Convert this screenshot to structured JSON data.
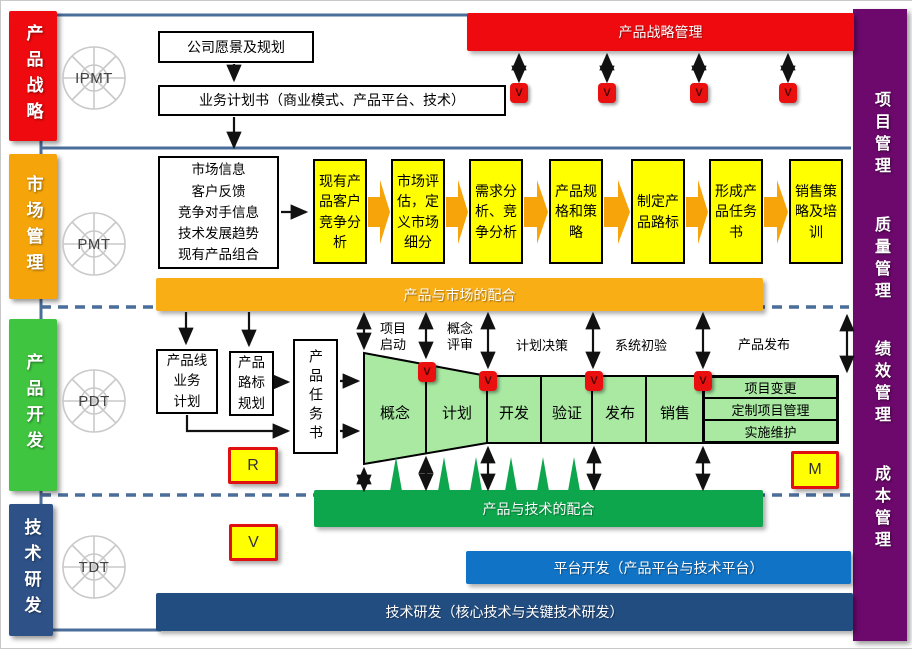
{
  "title": "IPD流程总体框架图",
  "left_bars": [
    {
      "label": "产品战略",
      "color": "#ee0a0e"
    },
    {
      "label": "市场管理",
      "color": "#f5a50a"
    },
    {
      "label": "产品开发",
      "color": "#3fc53f"
    },
    {
      "label": "技术研发",
      "color": "#2e5288"
    }
  ],
  "teams": [
    {
      "label": "IPMT"
    },
    {
      "label": "PMT"
    },
    {
      "label": "PDT"
    },
    {
      "label": "TDT"
    }
  ],
  "right_bar": {
    "items": [
      "项目管理",
      "质量管理",
      "绩效管理",
      "成本管理"
    ]
  },
  "strategy": {
    "banner": "产品战略管理",
    "vision_box": "公司愿景及规划",
    "business_plan_box": "业务计划书（商业模式、产品平台、技术）"
  },
  "market": {
    "inputs_box": "市场信息\n客户反馈\n竞争对手信息\n技术发展趋势\n现有产品组合",
    "steps": [
      "现有产品客户竞争分析",
      "市场评估，定义市场细分",
      "需求分析、竞争分析",
      "产品规格和策略",
      "制定产品路标",
      "形成产品任务书",
      "销售策略及培训"
    ],
    "banner": "产品与市场的配合"
  },
  "development": {
    "product_line_plan_box": "产品线\n业务\n计划",
    "roadmap_box": "产品\n路标\n规划",
    "charter_box": "产品任务书",
    "gate_labels": [
      "项目\n启动",
      "概念\n评审",
      "计划决策",
      "系统初验",
      "产品发布"
    ],
    "funnel_stages": [
      "概念",
      "计划",
      "开发",
      "验证",
      "发布",
      "销售"
    ],
    "ops_boxes": [
      "项目变更",
      "定制项目管理",
      "实施维护"
    ],
    "review_r": "R",
    "milestone_m": "M",
    "banner": "产品与技术的配合"
  },
  "tech": {
    "review_v": "V",
    "platform_banner": "平台开发（产品平台与技术平台）",
    "research_banner": "技术研发（核心技术与关键技术研发）"
  },
  "gate_symbol": "V",
  "colors": {
    "line_blue": "#4a6d99",
    "red": "#ee0a0e",
    "orange_bar": "#f5a50a",
    "orange_banner": "#f9ae15",
    "green_bar": "#3fc53f",
    "funnel_green": "#a9e9a2",
    "green_banner": "#0da64c",
    "platform_blue": "#1173c5",
    "research_navy": "#224d80",
    "tech_bar_blue": "#2e5288",
    "purple": "#6d096d",
    "yellow": "#ffff00",
    "gate_red": "#eb1010"
  }
}
